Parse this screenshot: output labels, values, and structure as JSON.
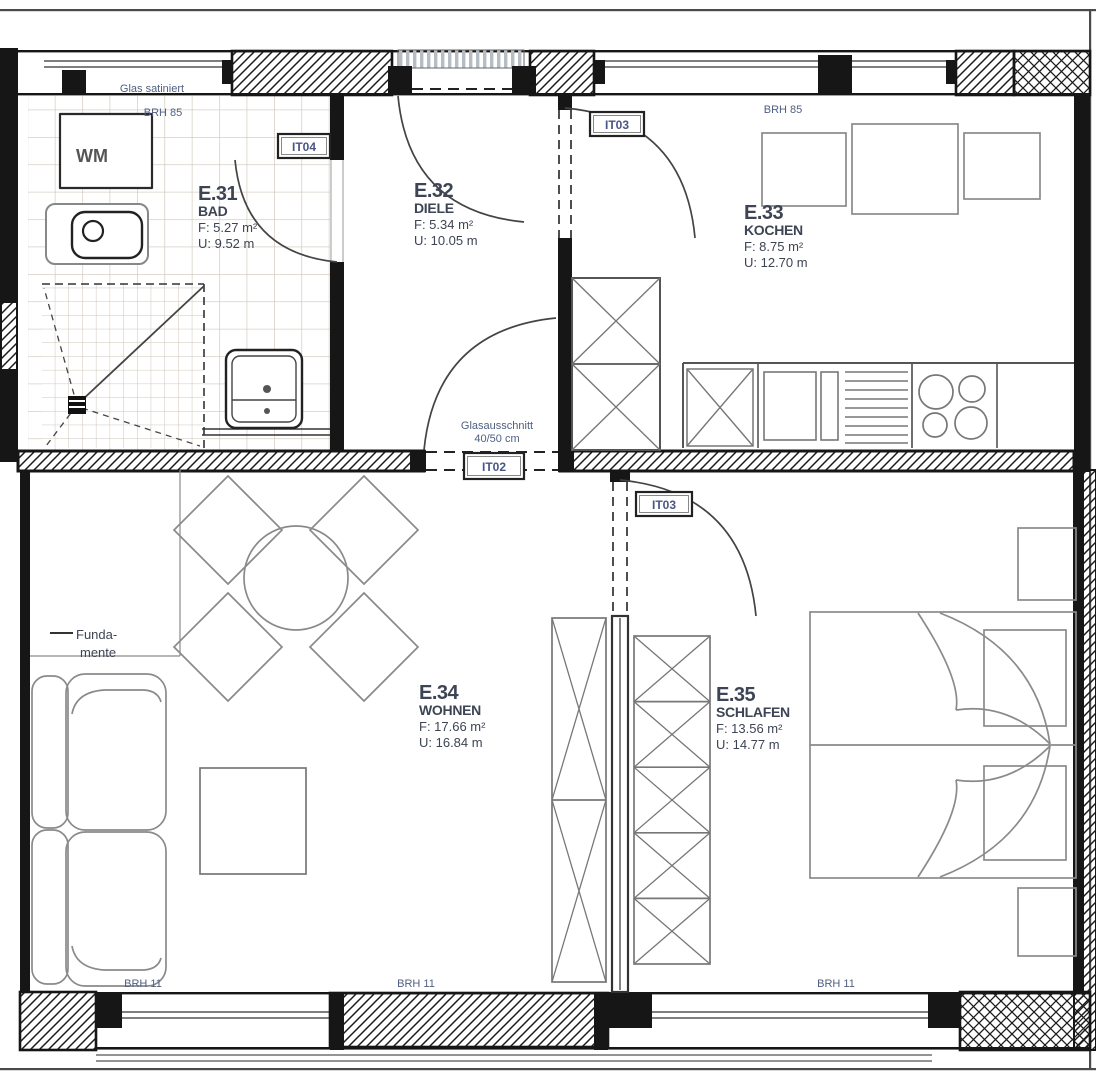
{
  "plan": {
    "rooms": [
      {
        "tag": "E.31",
        "name": "BAD",
        "area": "F: 5.27 m²",
        "perimeter": "U: 9.52 m"
      },
      {
        "tag": "E.32",
        "name": "DIELE",
        "area": "F: 5.34 m²",
        "perimeter": "U: 10.05 m"
      },
      {
        "tag": "E.33",
        "name": "KOCHEN",
        "area": "F: 8.75 m²",
        "perimeter": "U: 12.70 m"
      },
      {
        "tag": "E.34",
        "name": "WOHNEN",
        "area": "F: 17.66 m²",
        "perimeter": "U: 16.84 m"
      },
      {
        "tag": "E.35",
        "name": "SCHLAFEN",
        "area": "F: 13.56 m²",
        "perimeter": "U: 14.77 m"
      }
    ],
    "door_tags": {
      "bad": "IT04",
      "kitchen": "IT03",
      "entrance_mid": "IT02",
      "bedroom": "IT03"
    },
    "annotations": {
      "glas_satiniert": "Glas satiniert",
      "brh85_left": "BRH 85",
      "brh85_right": "BRH 85",
      "glasausschnitt_line1": "Glasausschnitt",
      "glasausschnitt_line2": "40/50 cm",
      "fundamente_line1": "Funda-",
      "fundamente_line2": "mente",
      "wm": "WM",
      "brh11_left": "BRH 11",
      "brh11_mid": "BRH 11",
      "brh11_right": "BRH 11"
    },
    "colors": {
      "wall": "#161616",
      "furniture": "#8a8a8a",
      "tile": "#cfc5ba",
      "annotation_text": "#4f5f82",
      "room_text": "#3d4454"
    }
  }
}
